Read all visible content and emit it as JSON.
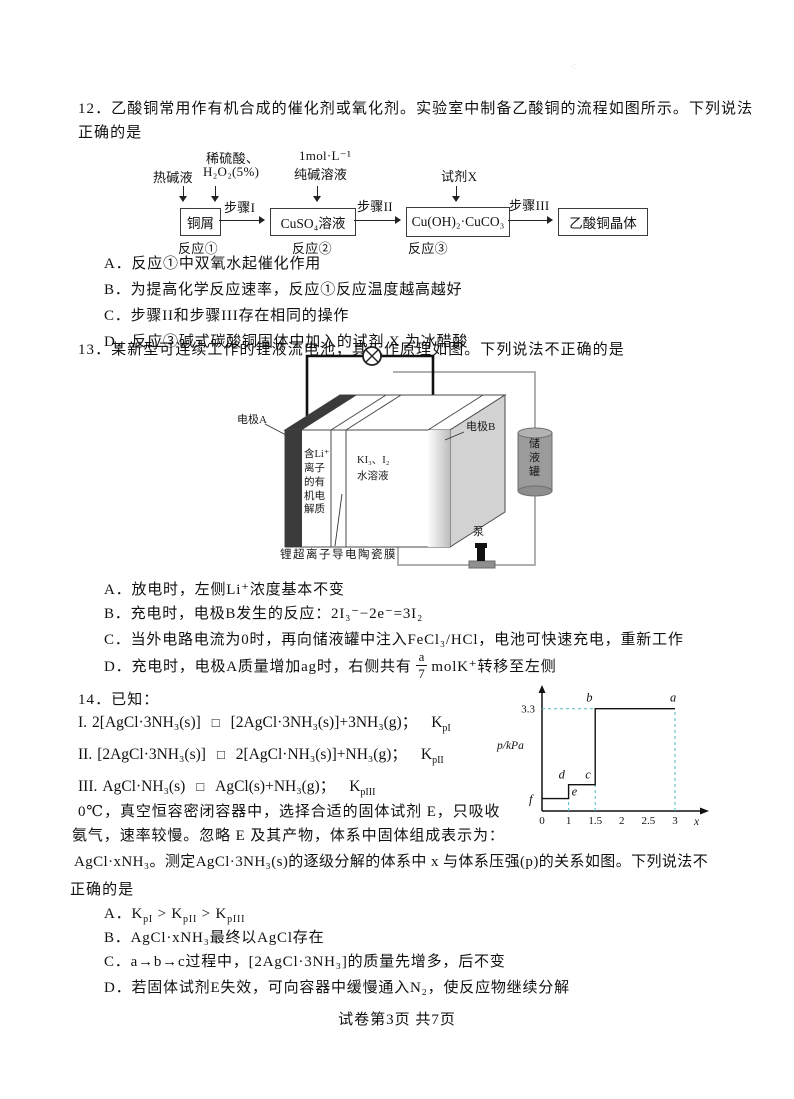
{
  "page": {
    "faint_mark": "⁖",
    "footer": "试卷第3页 共7页"
  },
  "q12": {
    "stem_line1": "12．乙酸铜常用作有机合成的催化剂或氧化剂。实验室中制备乙酸铜的流程如图所示。下列说法",
    "stem_line2": "正确的是",
    "flow": {
      "input_hot_alkali": "热碱液",
      "input_acid_line1": "稀硫酸、",
      "input_acid_line2": "H₂O₂(5%)",
      "input_soda_line1": "1mol·L⁻¹",
      "input_soda_line2": "纯碱溶液",
      "input_reagent_x": "试剂X",
      "box_copper": "铜屑",
      "box_cuso4": "CuSO₄溶液",
      "box_basic_carbonate": "Cu(OH)₂·CuCO₃",
      "box_product": "乙酸铜晶体",
      "step1": "步骤I",
      "step2": "步骤II",
      "step3": "步骤III",
      "rxn1": "反应①",
      "rxn2": "反应②",
      "rxn3": "反应③"
    },
    "options": [
      {
        "label": "A．",
        "text": "反应①中双氧水起催化作用"
      },
      {
        "label": "B．",
        "text": "为提高化学反应速率，反应①反应温度越高越好"
      },
      {
        "label": "C．",
        "text": "步骤II和步骤III存在相同的操作"
      },
      {
        "label": "D．",
        "text": "反应③碱式碳酸铜固体中加入的试剂 X 为冰醋酸"
      }
    ]
  },
  "q13": {
    "stem": "13．某新型可连续工作的锂液流电池，其工作原理如图。下列说法不正确的是",
    "diagram": {
      "electrode_a": "电极A",
      "electrode_b": "电极B",
      "electrolyte": "含Li⁺离子的有机电解质",
      "solution_line1": "KI₃、I₂",
      "solution_line2": "水溶液",
      "tank": "储液罐",
      "pump": "泵",
      "membrane": "锂超离子导电陶瓷膜"
    },
    "options": [
      {
        "label": "A．",
        "text": "放电时，左侧Li⁺浓度基本不变"
      },
      {
        "label": "B．",
        "text": "充电时，电极B发生的反应：2I₃⁻−2e⁻=3I₂"
      },
      {
        "label": "C．",
        "text": "当外电路电流为0时，再向储液罐中注入FeCl₃/HCl，电池可快速充电，重新工作"
      },
      {
        "label": "D．",
        "pre": "充电时，电极A质量增加ag时，右侧共有",
        "frac_num": "a",
        "frac_den": "7",
        "post": "molK⁺转移至左侧"
      }
    ]
  },
  "q14": {
    "stem": "14．已知：",
    "equations": [
      {
        "no": "I.",
        "lhs": "2[AgCl·3NH₃(s)]",
        "eq": "□",
        "rhs": "[2AgCl·3NH₃(s)]+3NH₃(g)；",
        "k": "K",
        "ksub": "pI"
      },
      {
        "no": "II.",
        "lhs": "[2AgCl·3NH₃(s)]",
        "eq": "□",
        "rhs": "2[AgCl·NH₃(s)]+NH₃(g)；",
        "k": "K",
        "ksub": "pII"
      },
      {
        "no": "III.",
        "lhs": "AgCl·NH₃(s)",
        "eq": "□",
        "rhs": "AgCl(s)+NH₃(g)；",
        "k": "K",
        "ksub": "pIII"
      }
    ],
    "para_line1": "0℃，真空恒容密闭容器中，选择合适的固体试剂 E，只吸收",
    "para_line2": "氨气，速率较慢。忽略 E 及其产物，体系中固体组成表示为：",
    "para_line3": "AgCl·xNH₃。测定AgCl·3NH₃(s)的逐级分解的体系中 x 与体系压强(p)的关系如图。下列说法不",
    "para_line4": "正确的是",
    "options": [
      {
        "label": "A．",
        "k1": "K",
        "s1": "pI",
        "op1": " > ",
        "k2": "K",
        "s2": "pII",
        "op2": " > ",
        "k3": "K",
        "s3": "pIII"
      },
      {
        "label": "B．",
        "text": "AgCl·xNH₃最终以AgCl存在"
      },
      {
        "label": "C．",
        "text": "a→b→c过程中，[2AgCl·3NH₃]的质量先增多，后不变"
      },
      {
        "label": "D．",
        "text": "若固体试剂E失效，可向容器中缓慢通入N₂，使反应物继续分解"
      }
    ],
    "chart_data": {
      "type": "line",
      "title": "",
      "xlabel": "x",
      "ylabel": "p/kPa",
      "xlim": [
        0,
        3.4
      ],
      "ylim": [
        0,
        3.9
      ],
      "x_ticks": [
        0,
        1,
        1.5,
        2,
        2.5,
        3
      ],
      "y_ticks": [
        3.3
      ],
      "grid": false,
      "series": [
        {
          "name": "体系压强p与x关系",
          "points": [
            [
              0,
              0.4
            ],
            [
              1,
              0.4
            ],
            [
              1,
              0.85
            ],
            [
              1.5,
              0.85
            ],
            [
              1.5,
              3.3
            ],
            [
              3,
              3.3
            ]
          ]
        }
      ],
      "point_labels": [
        {
          "label": "a",
          "x": 3,
          "y": 3.3
        },
        {
          "label": "b",
          "x": 1.5,
          "y": 3.3
        },
        {
          "label": "c",
          "x": 1.5,
          "y": 0.85
        },
        {
          "label": "d",
          "x": 1,
          "y": 0.85
        },
        {
          "label": "e",
          "x": 1,
          "y": 0.4
        },
        {
          "label": "f",
          "x": 0,
          "y": 0.4
        }
      ],
      "dashed_guides": [
        [
          [
            0,
            3.3
          ],
          [
            1.5,
            3.3
          ]
        ],
        [
          [
            1,
            0
          ],
          [
            1,
            0.4
          ]
        ],
        [
          [
            1.5,
            0
          ],
          [
            1.5,
            0.85
          ]
        ],
        [
          [
            3,
            0
          ],
          [
            3,
            3.3
          ]
        ]
      ],
      "dash_color": "#4db9c2",
      "line_color": "#111111"
    }
  }
}
